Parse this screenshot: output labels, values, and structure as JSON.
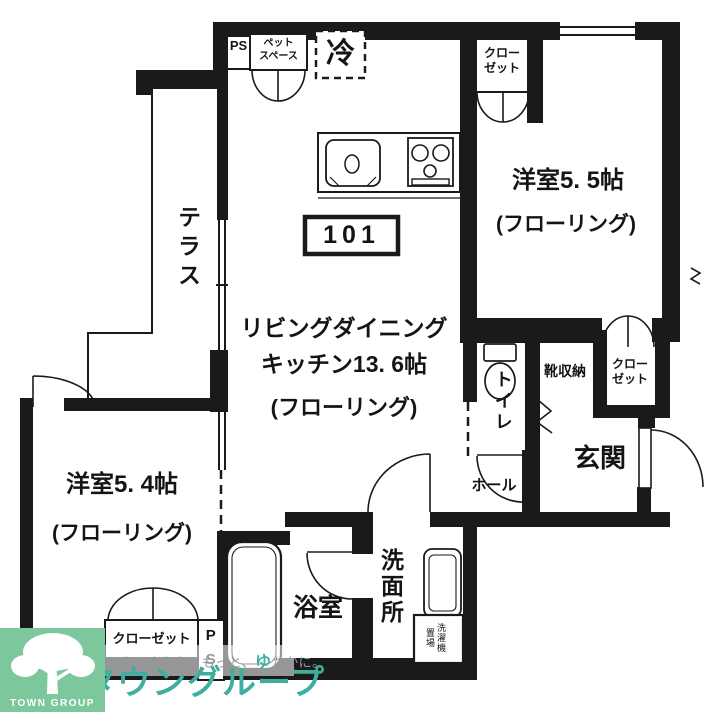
{
  "floorplan": {
    "unit_number": "101",
    "labels": {
      "terrace": "テラス",
      "ldk_line1": "リビングダイニング",
      "ldk_line2": "キッチン13. 6帖",
      "ldk_line3": "(フローリング)",
      "room55": "洋室5. 5帖",
      "room55_flooring": "(フローリング)",
      "room54": "洋室5. 4帖",
      "room54_flooring": "(フローリング)",
      "closet_room55": "クロー\nゼット",
      "closet_entry": "クロー\nゼット",
      "closet_room54": "クローゼット",
      "pet_space": "ペット\nスペース",
      "refrigerator": "冷",
      "ps_top": "PS",
      "ps_bottom": "PS",
      "toilet": "トイレ",
      "hall": "ホール",
      "shoe_storage": "靴収納",
      "entrance": "玄関",
      "bathroom": "浴室",
      "washroom": "洗面所",
      "laundry": "洗濯機置場"
    },
    "fixtures": [
      "kitchen-sink",
      "gas-stove",
      "refrigerator",
      "toilet",
      "bathtub",
      "vanity-sink",
      "washing-machine"
    ],
    "colors": {
      "wall": "#1a1a1a",
      "background": "#ffffff"
    },
    "watermark": {
      "tagline_part1": "ひとを、まちを、もっと、",
      "tagline_accent": "ゆ",
      "tagline_part2": "たかに。",
      "brand": "タウングループ",
      "logo_text": "TOWN GROUP",
      "brand_color": "#3fae9f",
      "logo_bg": "#7cc79c"
    }
  }
}
